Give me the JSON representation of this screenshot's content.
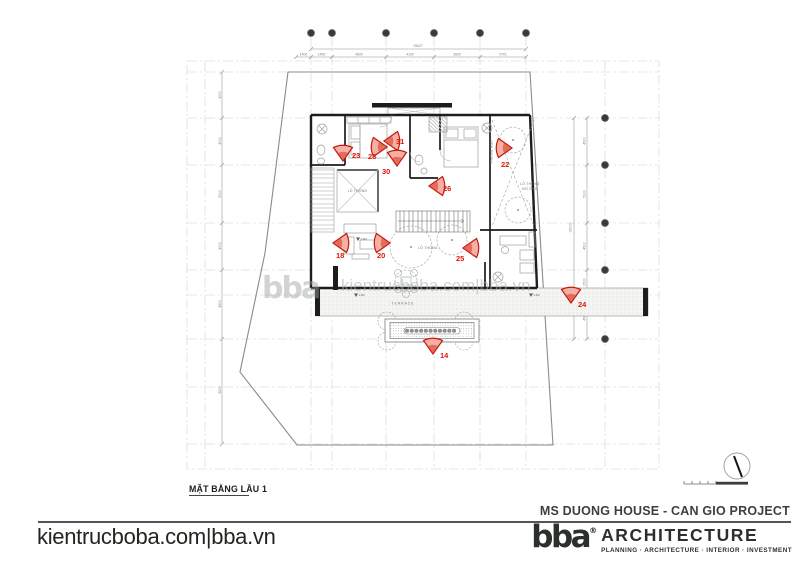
{
  "plan": {
    "title": "MẶT BẰNG LẦU 1",
    "watermark_text": "kientrucboba.com|bba.vn",
    "watermark_brand": "bba",
    "room_labels": {
      "void_left": "LỖ THÔNG",
      "void_court": "LỖ THÔNG",
      "void_right_line1": "LỖ THÔNG",
      "void_right_line2": "ĐỔ ỐNG",
      "terrace": "TERRACE",
      "bedroom_vertical": "PHÒNG NGỦ",
      "level_mark": "1.0M"
    },
    "markers": [
      {
        "id": "23",
        "x": 343,
        "y": 161,
        "dir": "down",
        "lx": 352,
        "ly": 158
      },
      {
        "id": "28",
        "x": 387,
        "y": 147,
        "dir": "right",
        "lx": 368,
        "ly": 159
      },
      {
        "id": "31",
        "x": 384,
        "y": 141,
        "dir": "left",
        "lx": 396,
        "ly": 144
      },
      {
        "id": "30",
        "x": 397,
        "y": 166,
        "dir": "down",
        "lx": 382,
        "ly": 174
      },
      {
        "id": "26",
        "x": 429,
        "y": 186,
        "dir": "left",
        "lx": 443,
        "ly": 191
      },
      {
        "id": "22",
        "x": 512,
        "y": 148,
        "dir": "right",
        "lx": 501,
        "ly": 167
      },
      {
        "id": "18",
        "x": 333,
        "y": 243,
        "dir": "left",
        "lx": 336,
        "ly": 258
      },
      {
        "id": "20",
        "x": 390,
        "y": 243,
        "dir": "right",
        "lx": 377,
        "ly": 258
      },
      {
        "id": "25",
        "x": 463,
        "y": 248,
        "dir": "left",
        "lx": 456,
        "ly": 261
      },
      {
        "id": "24",
        "x": 571,
        "y": 303,
        "dir": "down",
        "lx": 578,
        "ly": 307
      },
      {
        "id": "14",
        "x": 433,
        "y": 354,
        "dir": "down",
        "lx": 440,
        "ly": 358
      }
    ],
    "dims": {
      "top_overall": "19627",
      "right_overall": "19000",
      "top": [
        {
          "v": "1400",
          "x": 303.5
        },
        {
          "v": "1400",
          "x": 321.5
        },
        {
          "v": "4600",
          "x": 359
        },
        {
          "v": "4100",
          "x": 410
        },
        {
          "v": "3600",
          "x": 457
        },
        {
          "v": "4701",
          "x": 503
        }
      ],
      "left": [
        {
          "v": "4000",
          "y": 95
        },
        {
          "v": "4000",
          "y": 141
        },
        {
          "v": "5000",
          "y": 194
        },
        {
          "v": "4000",
          "y": 246
        },
        {
          "v": "4500",
          "y": 304
        },
        {
          "v": "5200",
          "y": 390
        }
      ],
      "right": [
        {
          "v": "4500",
          "y": 141
        },
        {
          "v": "5000",
          "y": 194
        },
        {
          "v": "4500",
          "y": 246
        },
        {
          "v": "2500",
          "y": 282
        },
        {
          "v": "4500",
          "y": 317
        }
      ]
    },
    "grid": {
      "bubbles_top_x": [
        311,
        332,
        386,
        434,
        480,
        526
      ],
      "bubbles_right_y": [
        118,
        165,
        223,
        270,
        295,
        339
      ]
    },
    "colors": {
      "marker_stroke": "#c3180a",
      "marker_fill": "#f5b0a6",
      "marker_inner": "#e0604d",
      "wall": "#1d1d1d",
      "line": "#9aa29e",
      "grid": "#cdd2cd",
      "boundary": "#878d87"
    }
  },
  "footer": {
    "site_url": "kientrucboba.com|bba.vn",
    "project_title": "MS DUONG HOUSE - CAN GIO PROJECT",
    "logo_brand": "bba",
    "logo_reg": "®",
    "logo_name": "ARCHITECTURE",
    "logo_tagline": "PLANNING · ARCHITECTURE · INTERIOR · INVESTMENT"
  }
}
